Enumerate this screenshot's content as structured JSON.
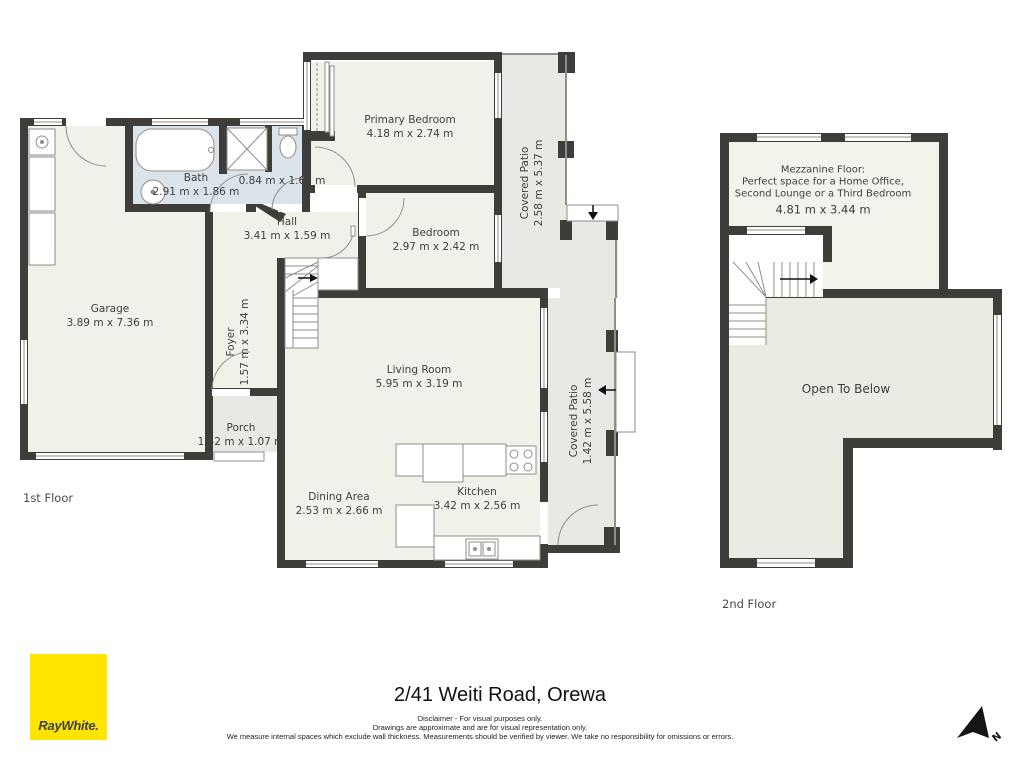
{
  "colors": {
    "wall": "#3e3d3a",
    "room_fill": "#f2f1e9",
    "bath_fill": "#dbe4ea",
    "patio_fill": "#e9e8e4",
    "open_fill": "#ecebe3",
    "line": "#8f8e8a",
    "brand_yellow": "#ffe400"
  },
  "floors": {
    "first": {
      "label": "1st Floor",
      "rooms": [
        {
          "id": "garage",
          "name": "Garage",
          "dims": "3.89 m x 7.36 m"
        },
        {
          "id": "bath",
          "name": "Bath",
          "dims": "2.91 m x 1.86 m"
        },
        {
          "id": "wc",
          "name": "",
          "dims": "0.84 m x 1.67 m"
        },
        {
          "id": "hall",
          "name": "Hall",
          "dims": "3.41 m x 1.59 m"
        },
        {
          "id": "primary-bedroom",
          "name": "Primary Bedroom",
          "dims": "4.18 m x 2.74 m"
        },
        {
          "id": "bedroom",
          "name": "Bedroom",
          "dims": "2.97 m x 2.42 m"
        },
        {
          "id": "covered-patio-top",
          "name": "Covered Patio",
          "dims": "2.58 m x 5.37 m"
        },
        {
          "id": "foyer",
          "name": "Foyer",
          "dims": "1.57 m x 3.34 m"
        },
        {
          "id": "living-room",
          "name": "Living Room",
          "dims": "5.95 m x 3.19 m"
        },
        {
          "id": "porch",
          "name": "Porch",
          "dims": "1.52 m x 1.07 m"
        },
        {
          "id": "dining-area",
          "name": "Dining Area",
          "dims": "2.53 m x 2.66 m"
        },
        {
          "id": "kitchen",
          "name": "Kitchen",
          "dims": "3.42 m x 2.56 m"
        },
        {
          "id": "covered-patio-right",
          "name": "Covered Patio",
          "dims": "1.42 m x 5.58 m"
        }
      ]
    },
    "second": {
      "label": "2nd Floor",
      "mezzanine": {
        "title": "Mezzanine Floor:",
        "line2": "Perfect space for a Home Office,",
        "line3": "Second Lounge or a Third Bedroom",
        "dims": "4.81 m x 3.44 m"
      },
      "open_to_below": "Open To Below"
    }
  },
  "footer": {
    "address": "2/41 Weiti Road, Orewa",
    "disclaimer": [
      "Disclaimer - For visual purposes only.",
      "Drawings are approximate and are for visual representation only.",
      "We measure internal spaces which exclude wall thickness. Measurements should be verified by viewer. We take no responsibility for omissions or errors."
    ],
    "brand": "RayWhite.",
    "compass_label": "N"
  }
}
